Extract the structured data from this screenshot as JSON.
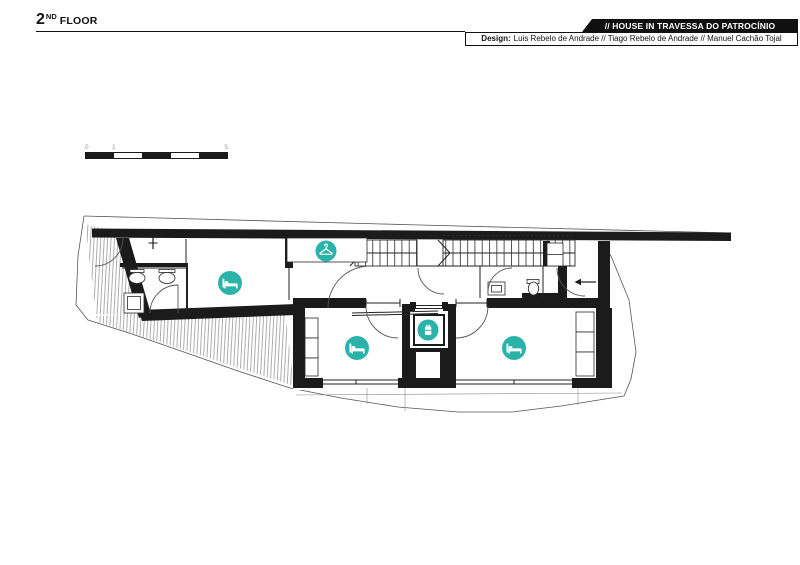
{
  "header": {
    "floor_number": "2",
    "floor_ordinal": "ND",
    "floor_label": "FLOOR",
    "project_title": "// HOUSE IN TRAVESSA DO PATROCÍNIO",
    "design_label": "Design:",
    "design_credits": "Luis Rebelo de Andrade // Tiago Rebelo de Andrade // Manuel Cachão Tojal"
  },
  "scale_bar": {
    "labels": [
      "0",
      "1",
      "5"
    ]
  },
  "colors": {
    "accent_teal": "#2BB3AA",
    "ink": "#111111"
  },
  "plan": {
    "icons": [
      {
        "name": "bed-icon",
        "glyph": "bed",
        "x": 230,
        "y": 283,
        "r": 12
      },
      {
        "name": "hanger-icon",
        "glyph": "hanger",
        "x": 326,
        "y": 251,
        "r": 10.5
      },
      {
        "name": "elevator-icon",
        "glyph": "elev",
        "x": 428,
        "y": 330,
        "r": 10.5
      },
      {
        "name": "bed-icon",
        "glyph": "bed",
        "x": 357,
        "y": 348,
        "r": 12
      },
      {
        "name": "bed-icon",
        "glyph": "bed",
        "x": 514,
        "y": 348,
        "r": 12
      }
    ]
  }
}
